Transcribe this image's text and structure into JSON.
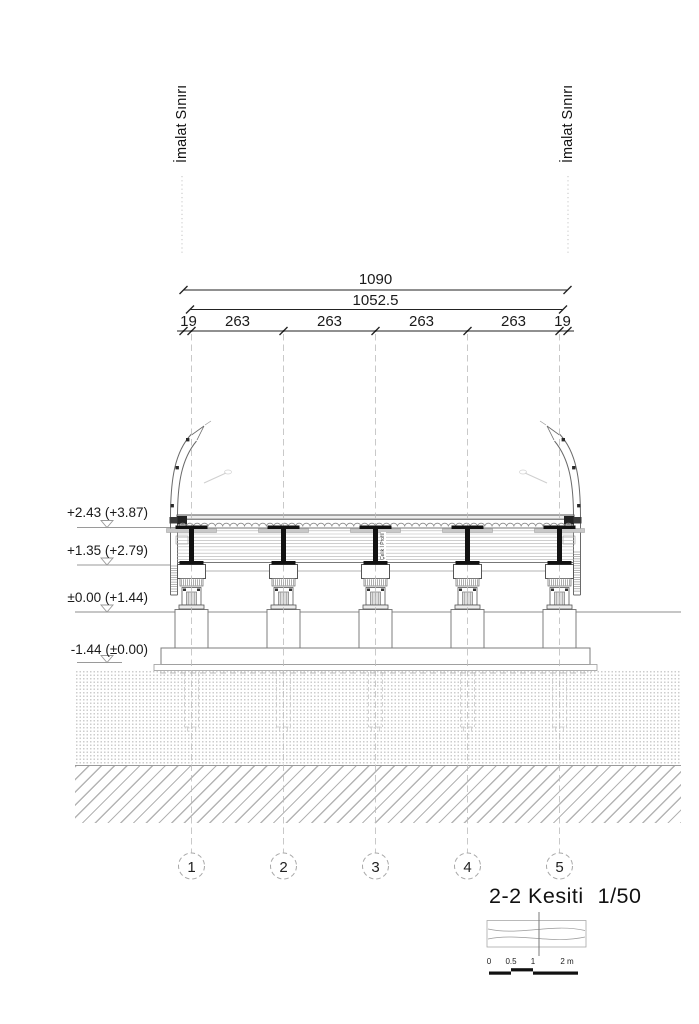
{
  "colors": {
    "ink": "#1a1a1a",
    "structure_line": "#6a6a6a",
    "steel_fill": "#111111",
    "light_line": "#b8b8b8"
  },
  "top_labels": {
    "left": "İmalat Sınırı",
    "right": "İmalat Sınırı"
  },
  "dimensions": {
    "total": "1090",
    "inner": "1052.5",
    "segments": [
      "19",
      "263",
      "263",
      "263",
      "263",
      "19"
    ]
  },
  "elevations": {
    "levels": [
      "+2.43 (+3.87)",
      "+1.35 (+2.79)",
      "±0.00 (+1.44)",
      "-1.44 (±0.00)"
    ]
  },
  "structure_labels": {
    "steel_profile": "Çelik I Profil"
  },
  "axes": {
    "numbers": [
      "1",
      "2",
      "3",
      "4",
      "5"
    ]
  },
  "title_block": {
    "title": "2-2 Kesiti",
    "scale": "1/50"
  },
  "scale_bar": {
    "ticks": [
      "0",
      "0.5",
      "1"
    ],
    "end_label": "2 m"
  }
}
